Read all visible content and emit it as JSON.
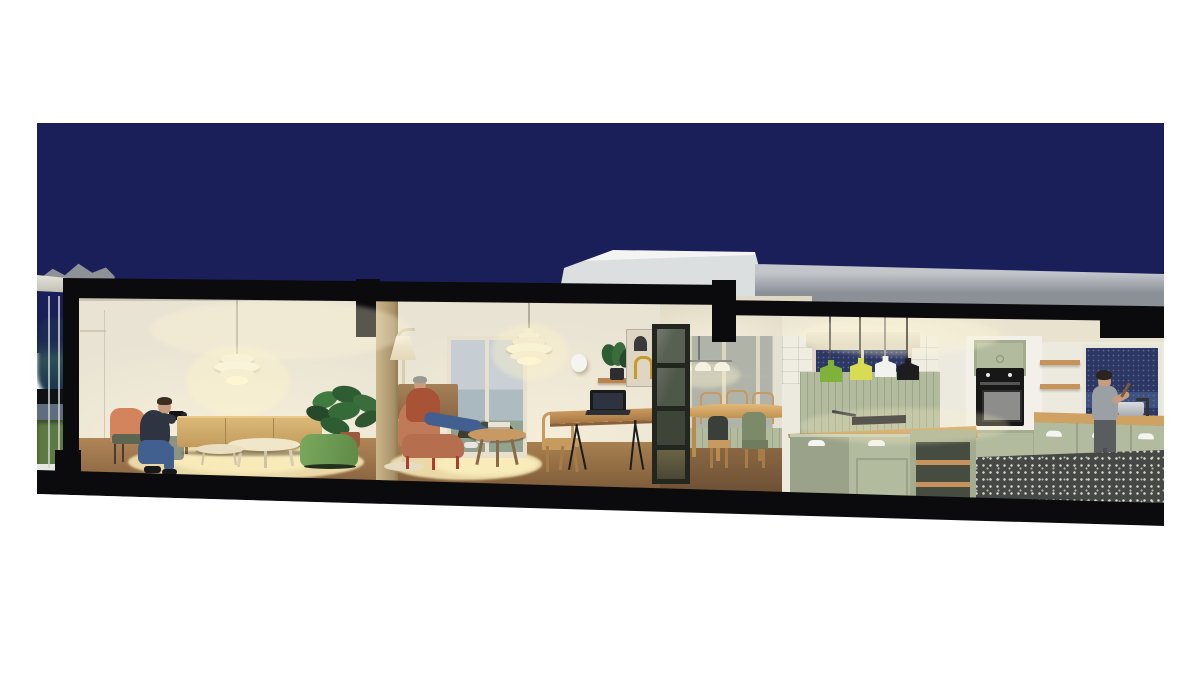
{
  "scene": {
    "kind": "architectural sectional-perspective 3D rendering",
    "time_of_day": "night",
    "building": "single-storey flat-roof house cut lengthwise (black section poché at roof, end wall and floor slab)",
    "rooms": [
      {
        "name": "terrace",
        "elements": [
          "night-sky",
          "pergola",
          "full-height-glazing",
          "lawn",
          "horizon-clouds"
        ]
      },
      {
        "name": "living-room",
        "elements": [
          "ph-pendant-lamp",
          "orange-chair",
          "crouching-photographer",
          "oak-sideboard",
          "nesting-coffee-tables",
          "green-pouf",
          "monstera-plant",
          "lit-cream-rug"
        ]
      },
      {
        "name": "lounge-study",
        "elements": [
          "artichoke-pendant",
          "floor-lamp",
          "terracotta-armchair",
          "seated-person",
          "round-coffee-table",
          "round-rug",
          "courtyard-window",
          "desk",
          "laptop",
          "desk-chair",
          "wall-shelf",
          "shelf-plant",
          "arch-poster",
          "glazed-partition"
        ]
      },
      {
        "name": "dining-room",
        "elements": [
          "triple-dome-pendant",
          "farmhouse-table",
          "wooden-chairs",
          "glazed-doors",
          "sage-wainscot"
        ]
      },
      {
        "name": "kitchen",
        "elements": [
          "sage-island",
          "four-colour-pendants",
          "built-in-oven",
          "upper-cabinet",
          "open-shelves",
          "night-window",
          "counter-run",
          "sink",
          "cooking-person",
          "patterned-cement-tile-floor"
        ]
      }
    ],
    "people_count": 3,
    "rooftop": [
      "white-upper-volume",
      "grey-parapet-band"
    ]
  },
  "colors": {
    "page": "#ffffff",
    "sky": "#1a1e59",
    "cut_black": "#0b0b0d",
    "wall_cream": "#e9e3d3",
    "ceiling_cream": "#f2ecdb",
    "wood_floor": "#a8804f",
    "wood_floor_dark": "#84613e",
    "rug_cream": "#ead9a7",
    "oak": "#cdaa6b",
    "sage": "#b2bb9e",
    "sage_dark": "#a3ac8e",
    "counter_wood": "#cfa263",
    "tile_dark": "#454844",
    "lawn": "#5d7a43",
    "pouf_green": "#6f9e56",
    "chair_orange": "#d4845c",
    "armchair_terracotta": "#c07a58",
    "pendant_green": "#7fb239",
    "pendant_yellow": "#d8dc52",
    "pendant_white": "#f2f2ee",
    "pendant_black": "#1d1d1f",
    "glass_blue": "#9fb0bf",
    "night_window": "#2c3763",
    "roof_white": "#f1f2f1",
    "roof_grey": "#9aa0a8",
    "denim": "#41608f",
    "skin": "#c99c7e",
    "jacket_navy": "#2e3442",
    "tee_grey": "#9aa0a4",
    "column_tan": "#c2b089"
  }
}
